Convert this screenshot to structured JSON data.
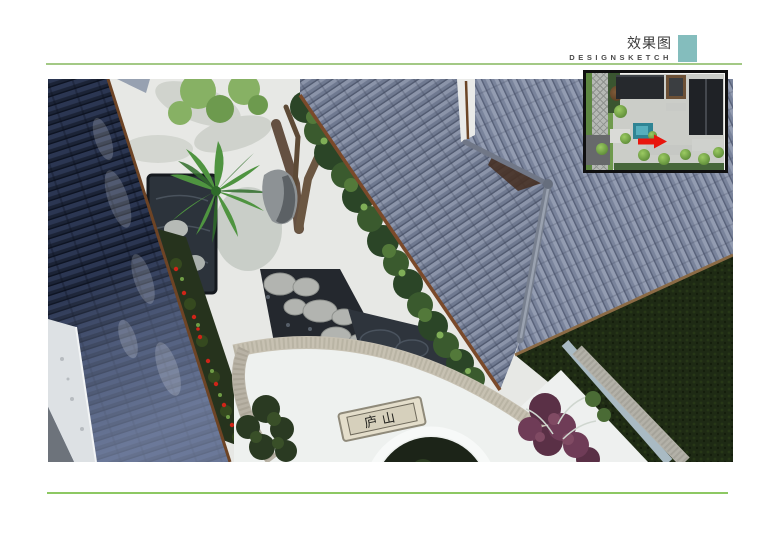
{
  "header": {
    "title_cn": "效果图",
    "title_en": "DESIGNSKETCH"
  },
  "accent": {
    "teal_square": "#84bdbd",
    "top_rule": "#a3c985",
    "bottom_rule": "#8dc863",
    "arrow_red": "#e8150d"
  },
  "photo": {
    "plaque_text": "庐山"
  }
}
